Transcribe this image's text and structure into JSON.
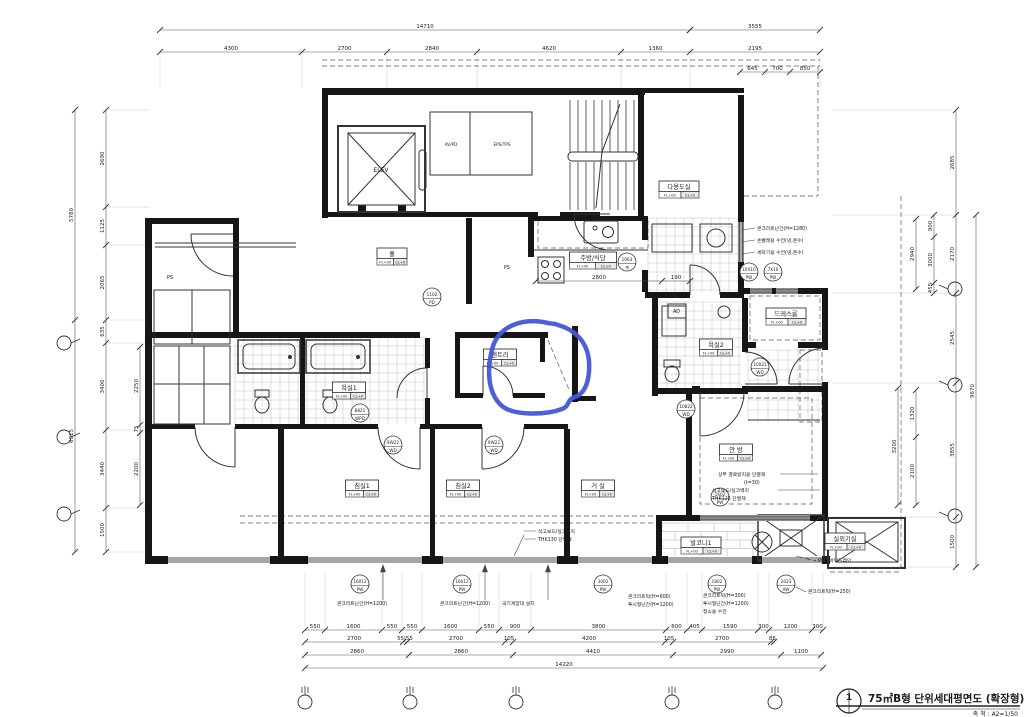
{
  "drawing": {
    "title_no": "1",
    "title": "75㎡B형 단위세대평면도 (확장형)",
    "scale_label": "축 척 : A2=1/50"
  },
  "core": {
    "elevator": "ELEV",
    "duct_left": "AV/PD",
    "duct_right": "EPS/TPS"
  },
  "label_sub": {
    "fl": "FL+00",
    "cl": "CL+0"
  },
  "rooms": [
    {
      "name": "홀",
      "x": 392,
      "y": 257
    },
    {
      "name": "주방/식당",
      "x": 593,
      "y": 261
    },
    {
      "name": "다용도실",
      "x": 679,
      "y": 190
    },
    {
      "name": "팬트리",
      "x": 500,
      "y": 358
    },
    {
      "name": "드레스룸",
      "x": 786,
      "y": 317
    },
    {
      "name": "욕실1",
      "x": 349,
      "y": 391
    },
    {
      "name": "욕실2",
      "x": 716,
      "y": 348
    },
    {
      "name": "침실1",
      "x": 362,
      "y": 489
    },
    {
      "name": "침실2",
      "x": 463,
      "y": 489
    },
    {
      "name": "거 실",
      "x": 598,
      "y": 489
    },
    {
      "name": "안 방",
      "x": 736,
      "y": 453
    },
    {
      "name": "발코니1",
      "x": 701,
      "y": 546
    },
    {
      "name": "실외기실",
      "x": 845,
      "y": 542
    }
  ],
  "tags": [
    {
      "x": 393,
      "y": 445,
      "a": "9W22",
      "b": "WD"
    },
    {
      "x": 494,
      "y": 445,
      "a": "9W22",
      "b": "WD"
    },
    {
      "x": 360,
      "y": 413,
      "a": "8821",
      "b": "WPD"
    },
    {
      "x": 686,
      "y": 409,
      "a": "10822",
      "b": "WD"
    },
    {
      "x": 627,
      "y": 262,
      "a": "1063",
      "b": "계"
    },
    {
      "x": 749,
      "y": 272,
      "a": "10X10",
      "b": "PW"
    },
    {
      "x": 773,
      "y": 272,
      "a": "7X10",
      "b": "PW"
    },
    {
      "x": 760,
      "y": 367,
      "a": "10021",
      "b": "WD"
    },
    {
      "x": 432,
      "y": 297,
      "a": "1102",
      "b": "PD"
    },
    {
      "x": 360,
      "y": 584,
      "a": "16012",
      "b": "PW"
    },
    {
      "x": 462,
      "y": 584,
      "a": "16012",
      "b": "PW"
    },
    {
      "x": 603,
      "y": 584,
      "a": "3002",
      "b": "PW"
    },
    {
      "x": 717,
      "y": 584,
      "a": "1802",
      "b": "PW"
    },
    {
      "x": 786,
      "y": 584,
      "a": "2023",
      "b": "AW"
    },
    {
      "x": 720,
      "y": 497,
      "a": "1602",
      "b": "PW"
    }
  ],
  "notes": [
    {
      "x": 757,
      "y": 230,
      "t": "콘크리트난간(H=1280)"
    },
    {
      "x": 757,
      "y": 242,
      "t": "손빨래용 수전(냉,온수)"
    },
    {
      "x": 757,
      "y": 254,
      "t": "세탁기용 수전(냉,온수)"
    },
    {
      "x": 718,
      "y": 476,
      "t": "상부 결로방지용 단열재"
    },
    {
      "x": 744,
      "y": 484,
      "t": "(t=30)"
    },
    {
      "x": 712,
      "y": 492,
      "t": "석고보드/실크벽지"
    },
    {
      "x": 712,
      "y": 500,
      "t": "THK125 단열재"
    },
    {
      "x": 538,
      "y": 533,
      "t": "석고보드/실크벽지"
    },
    {
      "x": 538,
      "y": 541,
      "t": "THK130 단열재"
    },
    {
      "x": 337,
      "y": 605,
      "t": "콘크리트난간(H=1200)"
    },
    {
      "x": 440,
      "y": 605,
      "t": "콘크리트난간(H=1200)"
    },
    {
      "x": 502,
      "y": 605,
      "t": "국기게양대 설치"
    },
    {
      "x": 628,
      "y": 598,
      "t": "콘크리트턱(H=600)"
    },
    {
      "x": 628,
      "y": 606,
      "t": "투시형난간(H=1200)"
    },
    {
      "x": 703,
      "y": 597,
      "t": "콘크리트턱(H=300)"
    },
    {
      "x": 703,
      "y": 605,
      "t": "투시형난간(H=1200)"
    },
    {
      "x": 703,
      "y": 613,
      "t": "청소용 수전"
    },
    {
      "x": 808,
      "y": 593,
      "t": "콘크리트턱(H=250)"
    },
    {
      "x": 818,
      "y": 562,
      "t": "Ø75 바닥드레인"
    },
    {
      "x": 167,
      "y": 279,
      "t": "PS"
    },
    {
      "x": 504,
      "y": 269,
      "t": "PS"
    },
    {
      "x": 673,
      "y": 313,
      "t": "AD"
    }
  ],
  "dimensions": {
    "top_total": [
      "14710"
    ],
    "top_total2": [
      "3555"
    ],
    "top_row": [
      "4300",
      "2700",
      "2840",
      "4620",
      "1360",
      "2195"
    ],
    "top_sub": [
      "645",
      "700",
      "850"
    ],
    "left_total": [
      "5780",
      "6915"
    ],
    "left_row": [
      "2690",
      "1125",
      "2065",
      "635",
      "3400",
      "3440",
      "1500"
    ],
    "left_inner": [
      "2250",
      "75",
      "2200"
    ],
    "right_out": [
      "2685",
      "2170",
      "2545",
      "3855",
      "1500"
    ],
    "right_total": [
      "9670"
    ],
    "right_inner_a": [
      "900",
      "3000",
      "455"
    ],
    "right_inner_b": [
      "2940"
    ],
    "right_inner_c": [
      "1320",
      "2100"
    ],
    "right_inner_d": [
      "3200"
    ],
    "bottom_a": [
      "550",
      "1600",
      "550",
      "550",
      "1600",
      "550",
      "900",
      "3800",
      "600",
      "405",
      "1590",
      "300",
      "1200",
      "300"
    ],
    "bottom_b": [
      "2700",
      "55|55",
      "2700",
      "105",
      "4200",
      "105",
      "2700",
      "85"
    ],
    "bottom_c": [
      "2860",
      "2860",
      "4410",
      "2990",
      "1100"
    ],
    "bottom_total": [
      "14220"
    ],
    "kitchen": [
      "2800",
      "190"
    ]
  },
  "colors": {
    "line": "#1a1a1a",
    "dim": "#555555",
    "highlight": "#4556d8"
  }
}
